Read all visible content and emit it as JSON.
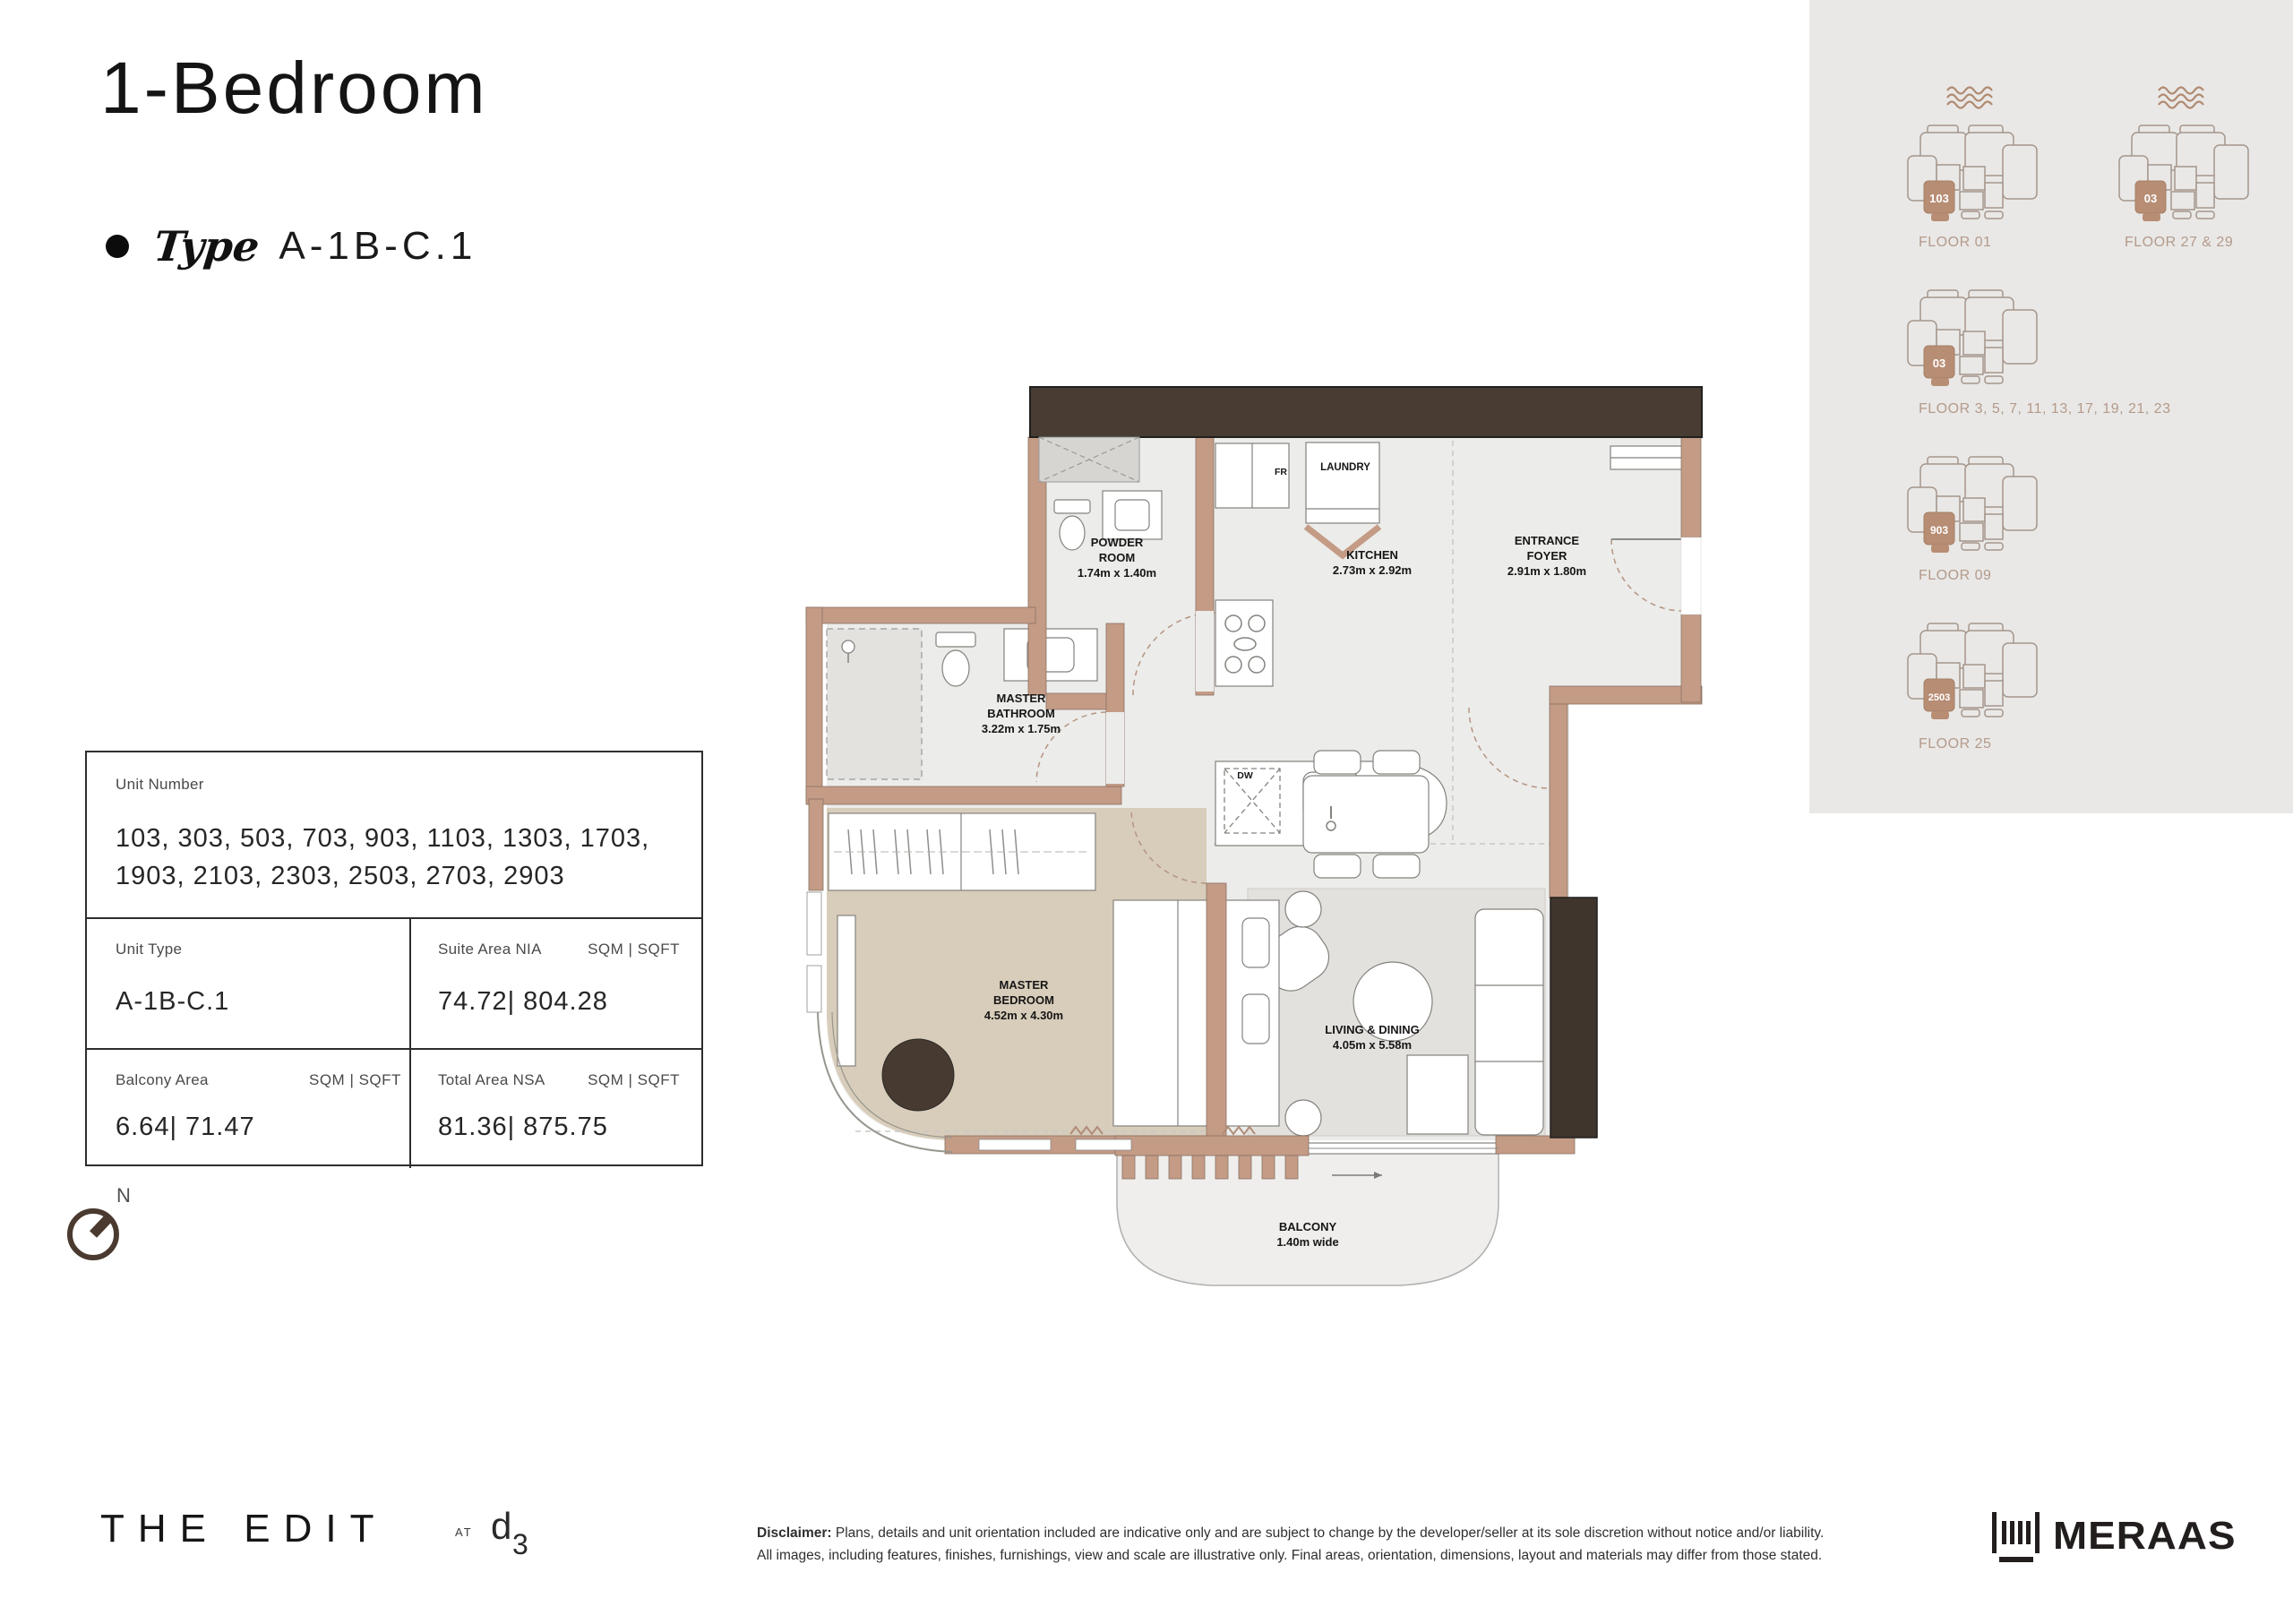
{
  "page": {
    "title": "1-Bedroom",
    "type_label": "Type",
    "type_value": "A-1B-C.1"
  },
  "info_table": {
    "unit_number_label": "Unit Number",
    "unit_number_line1": "103, 303, 503, 703, 903, 1103, 1303, 1703,",
    "unit_number_line2": "1903, 2103, 2303, 2503, 2703, 2903",
    "unit_type_label": "Unit Type",
    "unit_type_value": "A-1B-C.1",
    "suite_area_label": "Suite Area NIA",
    "suite_area_units": "SQM | SQFT",
    "suite_area_value": "74.72| 804.28",
    "balcony_area_label": "Balcony Area",
    "balcony_area_units": "SQM | SQFT",
    "balcony_area_value": "6.64| 71.47",
    "total_area_label": "Total Area NSA",
    "total_area_units": "SQM | SQFT",
    "total_area_value": "81.36| 875.75"
  },
  "compass": {
    "north_label": "N"
  },
  "floor_plan": {
    "rooms": {
      "powder": {
        "name": "POWDER ROOM",
        "dims": "1.74m x 1.40m"
      },
      "kitchen": {
        "name": "KITCHEN",
        "dims": "2.73m x 2.92m"
      },
      "foyer": {
        "name": "ENTRANCE FOYER",
        "dims": "2.91m x 1.80m"
      },
      "bath": {
        "name": "MASTER BATHROOM",
        "dims": "3.22m x 1.75m"
      },
      "bed": {
        "name": "MASTER BEDROOM",
        "dims": "4.52m x 4.30m"
      },
      "living": {
        "name": "LIVING & DINING",
        "dims": "4.05m x 5.58m"
      },
      "balcony": {
        "name": "BALCONY",
        "dims": "1.40m wide"
      }
    },
    "annotations": {
      "laundry": "LAUNDRY",
      "fridge": "FR",
      "dishwasher": "DW"
    }
  },
  "key_plans": [
    {
      "label": "FLOOR 01",
      "unit": "103"
    },
    {
      "label": "FLOOR 27 & 29",
      "unit": "03"
    },
    {
      "label": "FLOOR 3, 5, 7, 11, 13, 17, 19, 21, 23",
      "unit": "03"
    },
    {
      "label": "FLOOR 09",
      "unit": "903"
    },
    {
      "label": "FLOOR 25",
      "unit": "2503"
    }
  ],
  "footer": {
    "brand": "THE EDIT",
    "at_label": "AT",
    "d3_d": "d",
    "d3_3": "3",
    "disclaimer_label": "Disclaimer:",
    "disclaimer_line1": " Plans, details and unit orientation included are indicative only and are subject to change by the developer/seller at its sole discretion without notice and/or liability.",
    "disclaimer_line2": "All images, including features, finishes, furnishings, view and scale are illustrative only. Final areas, orientation, dimensions, layout and materials may differ from those stated.",
    "developer": "MERAAS"
  },
  "colors": {
    "wall": "#c49b85",
    "dark_bar": "#483c33",
    "floor_gray": "#ececea",
    "floor_beige": "#d8cdba",
    "sidebar_bg": "#e9e8e6",
    "keyplan_accent": "#b78d74"
  }
}
